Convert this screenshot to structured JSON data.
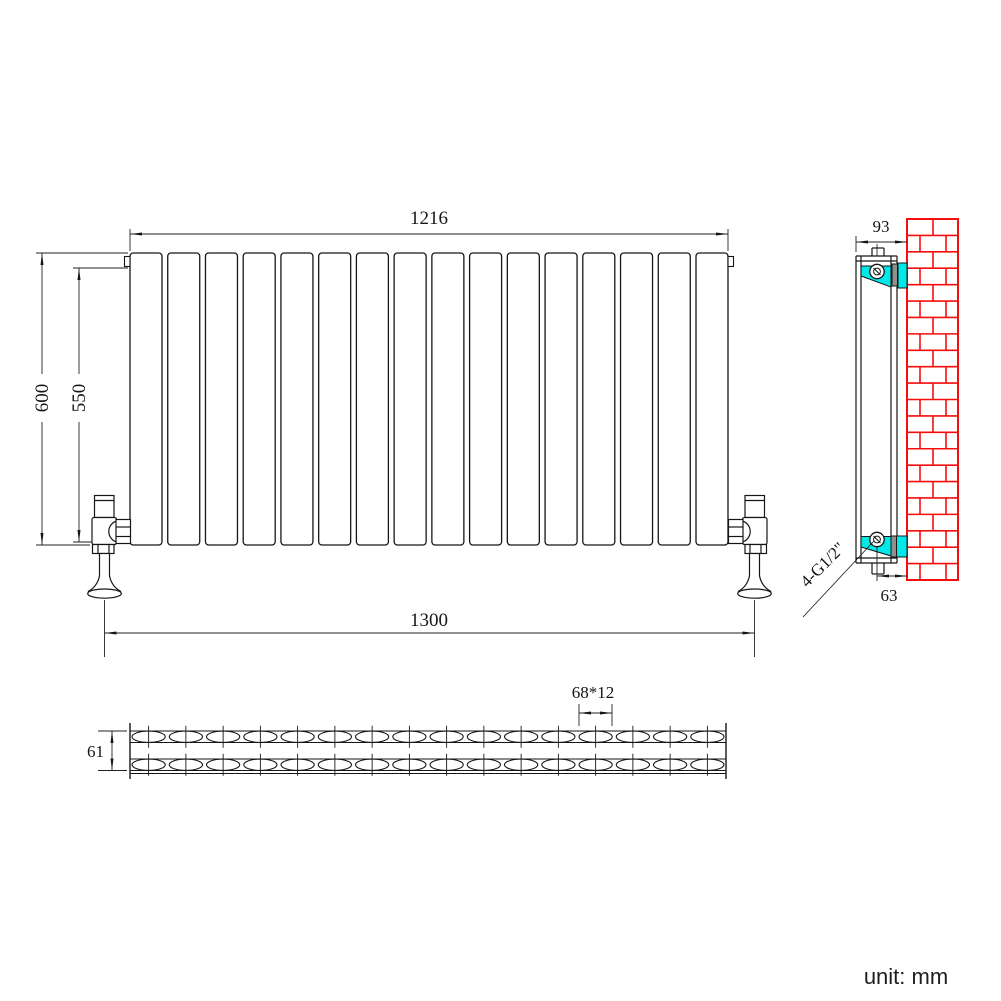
{
  "meta": {
    "unit_label": "unit: mm"
  },
  "colors": {
    "line": "#161616",
    "brick_red": "#f60d0d",
    "bracket_cyan": "#00e8e8",
    "bracket_gray": "#8f8f8f",
    "background": "#ffffff"
  },
  "front_view": {
    "panel_count": 16,
    "dims": {
      "width_top": "1216",
      "height": "600",
      "connection_height": "550",
      "valve_span": "1300"
    }
  },
  "side_view": {
    "dims": {
      "depth": "93",
      "bottom_offset": "63"
    },
    "connection_label": "4-G1/2\""
  },
  "section_view": {
    "tube_count": 16,
    "row_count": 2,
    "dims": {
      "depth": "61",
      "tube_size": "68*12"
    }
  }
}
